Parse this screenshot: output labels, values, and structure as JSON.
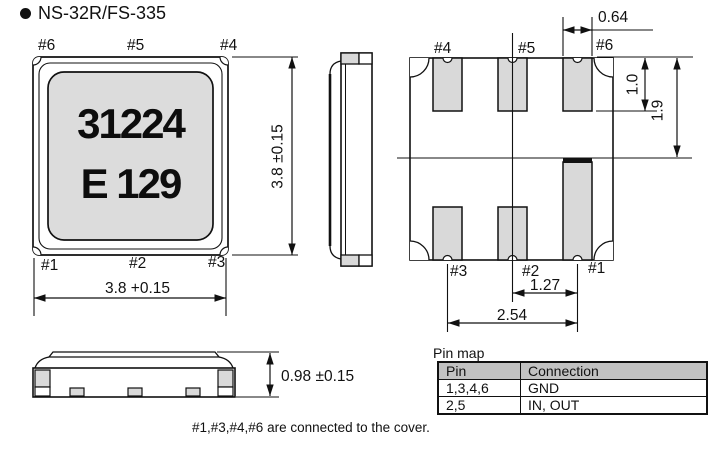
{
  "title": "NS-32R/FS-335",
  "front_view": {
    "marking_line1": "31224",
    "marking_line2": "E 129",
    "pin_top_left": "#6",
    "pin_top_center": "#5",
    "pin_top_right": "#4",
    "pin_bottom_left": "#1",
    "pin_bottom_center": "#2",
    "pin_bottom_right": "#3",
    "dim_width": "3.8 +0.15",
    "dim_height": "3.8 ±0.15"
  },
  "bottom_view": {
    "pin_top_left": "#4",
    "pin_top_center": "#5",
    "pin_top_right": "#6",
    "pin_bottom_left": "#3",
    "pin_bottom_center": "#2",
    "pin_bottom_right": "#1",
    "dim_pad_width": "0.64",
    "dim_pad_length": "1.0",
    "dim_edge_to_center": "1.9",
    "dim_pitch_half": "1.27",
    "dim_pitch_full": "2.54"
  },
  "side_profile": {
    "dim_height": "0.98 ±0.15"
  },
  "pin_map": {
    "label": "Pin map",
    "headers": [
      "Pin",
      "Connection"
    ],
    "rows": [
      [
        "1,3,4,6",
        "GND"
      ],
      [
        "2,5",
        "IN, OUT"
      ]
    ]
  },
  "note": "#1,#3,#4,#6 are connected to the cover.",
  "colors": {
    "line": "#111111",
    "pad_fill": "#d9d9d9",
    "marking_bg": "#dcdcdc",
    "table_header_bg": "#c2c2c2"
  }
}
